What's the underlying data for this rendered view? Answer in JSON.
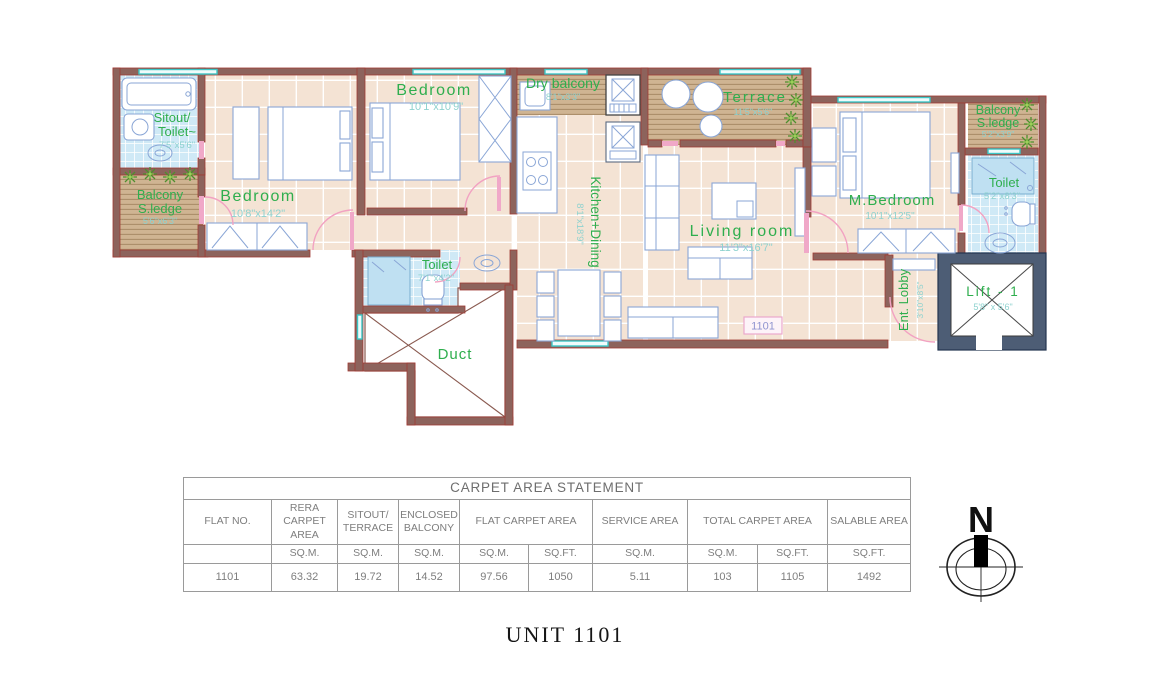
{
  "palette": {
    "wall": "#8d635c",
    "wall_edge": "#a03b34",
    "lift_wall": "#4d5d75",
    "floor": "#f4e3d4",
    "deck": "#cfb492",
    "toilet_floor": "#cfe9f6",
    "furniture_line": "#8aa6d6",
    "label_green": "#2fae4e",
    "dim_teal": "#8ed2cf",
    "door_pink": "#f2a2c2",
    "window_teal": "#3cc7c7",
    "plant_green": "#4e8f2f",
    "table_text": "#7e7e7e"
  },
  "plan": {
    "unit_badge": "1101",
    "rooms": {
      "sitout_toilet": {
        "line1": "Sitout/",
        "line2": "Toilet~",
        "dim": "7'5\"x5'6\""
      },
      "balcony_left": {
        "line1": "Balcony",
        "line2": "S.ledge",
        "dim": "5'6\"x6'3\""
      },
      "bedroom1": {
        "label": "Bedroom",
        "dim": "10'8\"x14'2\""
      },
      "bedroom2": {
        "label": "Bedroom",
        "dim": "10'1\"x10'9\""
      },
      "dry_balcony": {
        "label": "Dry balcony",
        "dim": "8'1\"x3'3\""
      },
      "kitchen_dining": {
        "label": "Kitchen+Dining",
        "dim": "8'1\"x18'9\""
      },
      "terrace": {
        "label": "Terrace",
        "dim": "11'5\"x5'6\""
      },
      "living_room": {
        "label": "Living room",
        "dim": "11'3\"x16'7\""
      },
      "m_bedroom": {
        "label": "M.Bedroom",
        "dim": "10'1\"x12'5\""
      },
      "balcony_right": {
        "line1": "Balcony",
        "line2": "S.ledge",
        "dim": "5'2\"x3'9\""
      },
      "toilet_right": {
        "label": "Toilet",
        "dim": "5'2\"x8'3\""
      },
      "toilet_mid": {
        "label": "Toilet",
        "dim": "7'1\"x4'2\""
      },
      "duct": {
        "label": "Duct"
      },
      "ent_lobby": {
        "label": "Ent. Lobby",
        "dim": "3'10\"x8'5\""
      },
      "lift": {
        "label": "Lift - 1",
        "dim": "5'8\" x 5'6\""
      }
    }
  },
  "table": {
    "title": "CARPET AREA STATEMENT",
    "groups": [
      {
        "label": "FLAT NO."
      },
      {
        "label": "RERA CARPET AREA"
      },
      {
        "label": "SITOUT/ TERRACE"
      },
      {
        "label": "ENCLOSED BALCONY"
      },
      {
        "label": "FLAT CARPET AREA"
      },
      {
        "label": "SERVICE AREA"
      },
      {
        "label": "TOTAL CARPET AREA"
      },
      {
        "label": "SALABLE AREA"
      }
    ],
    "units": [
      "",
      "SQ.M.",
      "SQ.M.",
      "SQ.M.",
      "SQ.M.",
      "SQ.FT.",
      "SQ.M.",
      "SQ.M.",
      "SQ.FT.",
      "SQ.FT."
    ],
    "values": [
      "1101",
      "63.32",
      "19.72",
      "14.52",
      "97.56",
      "1050",
      "5.11",
      "103",
      "1105",
      "1492"
    ]
  },
  "compass": {
    "label": "N"
  },
  "footer_title": "UNIT 1101"
}
